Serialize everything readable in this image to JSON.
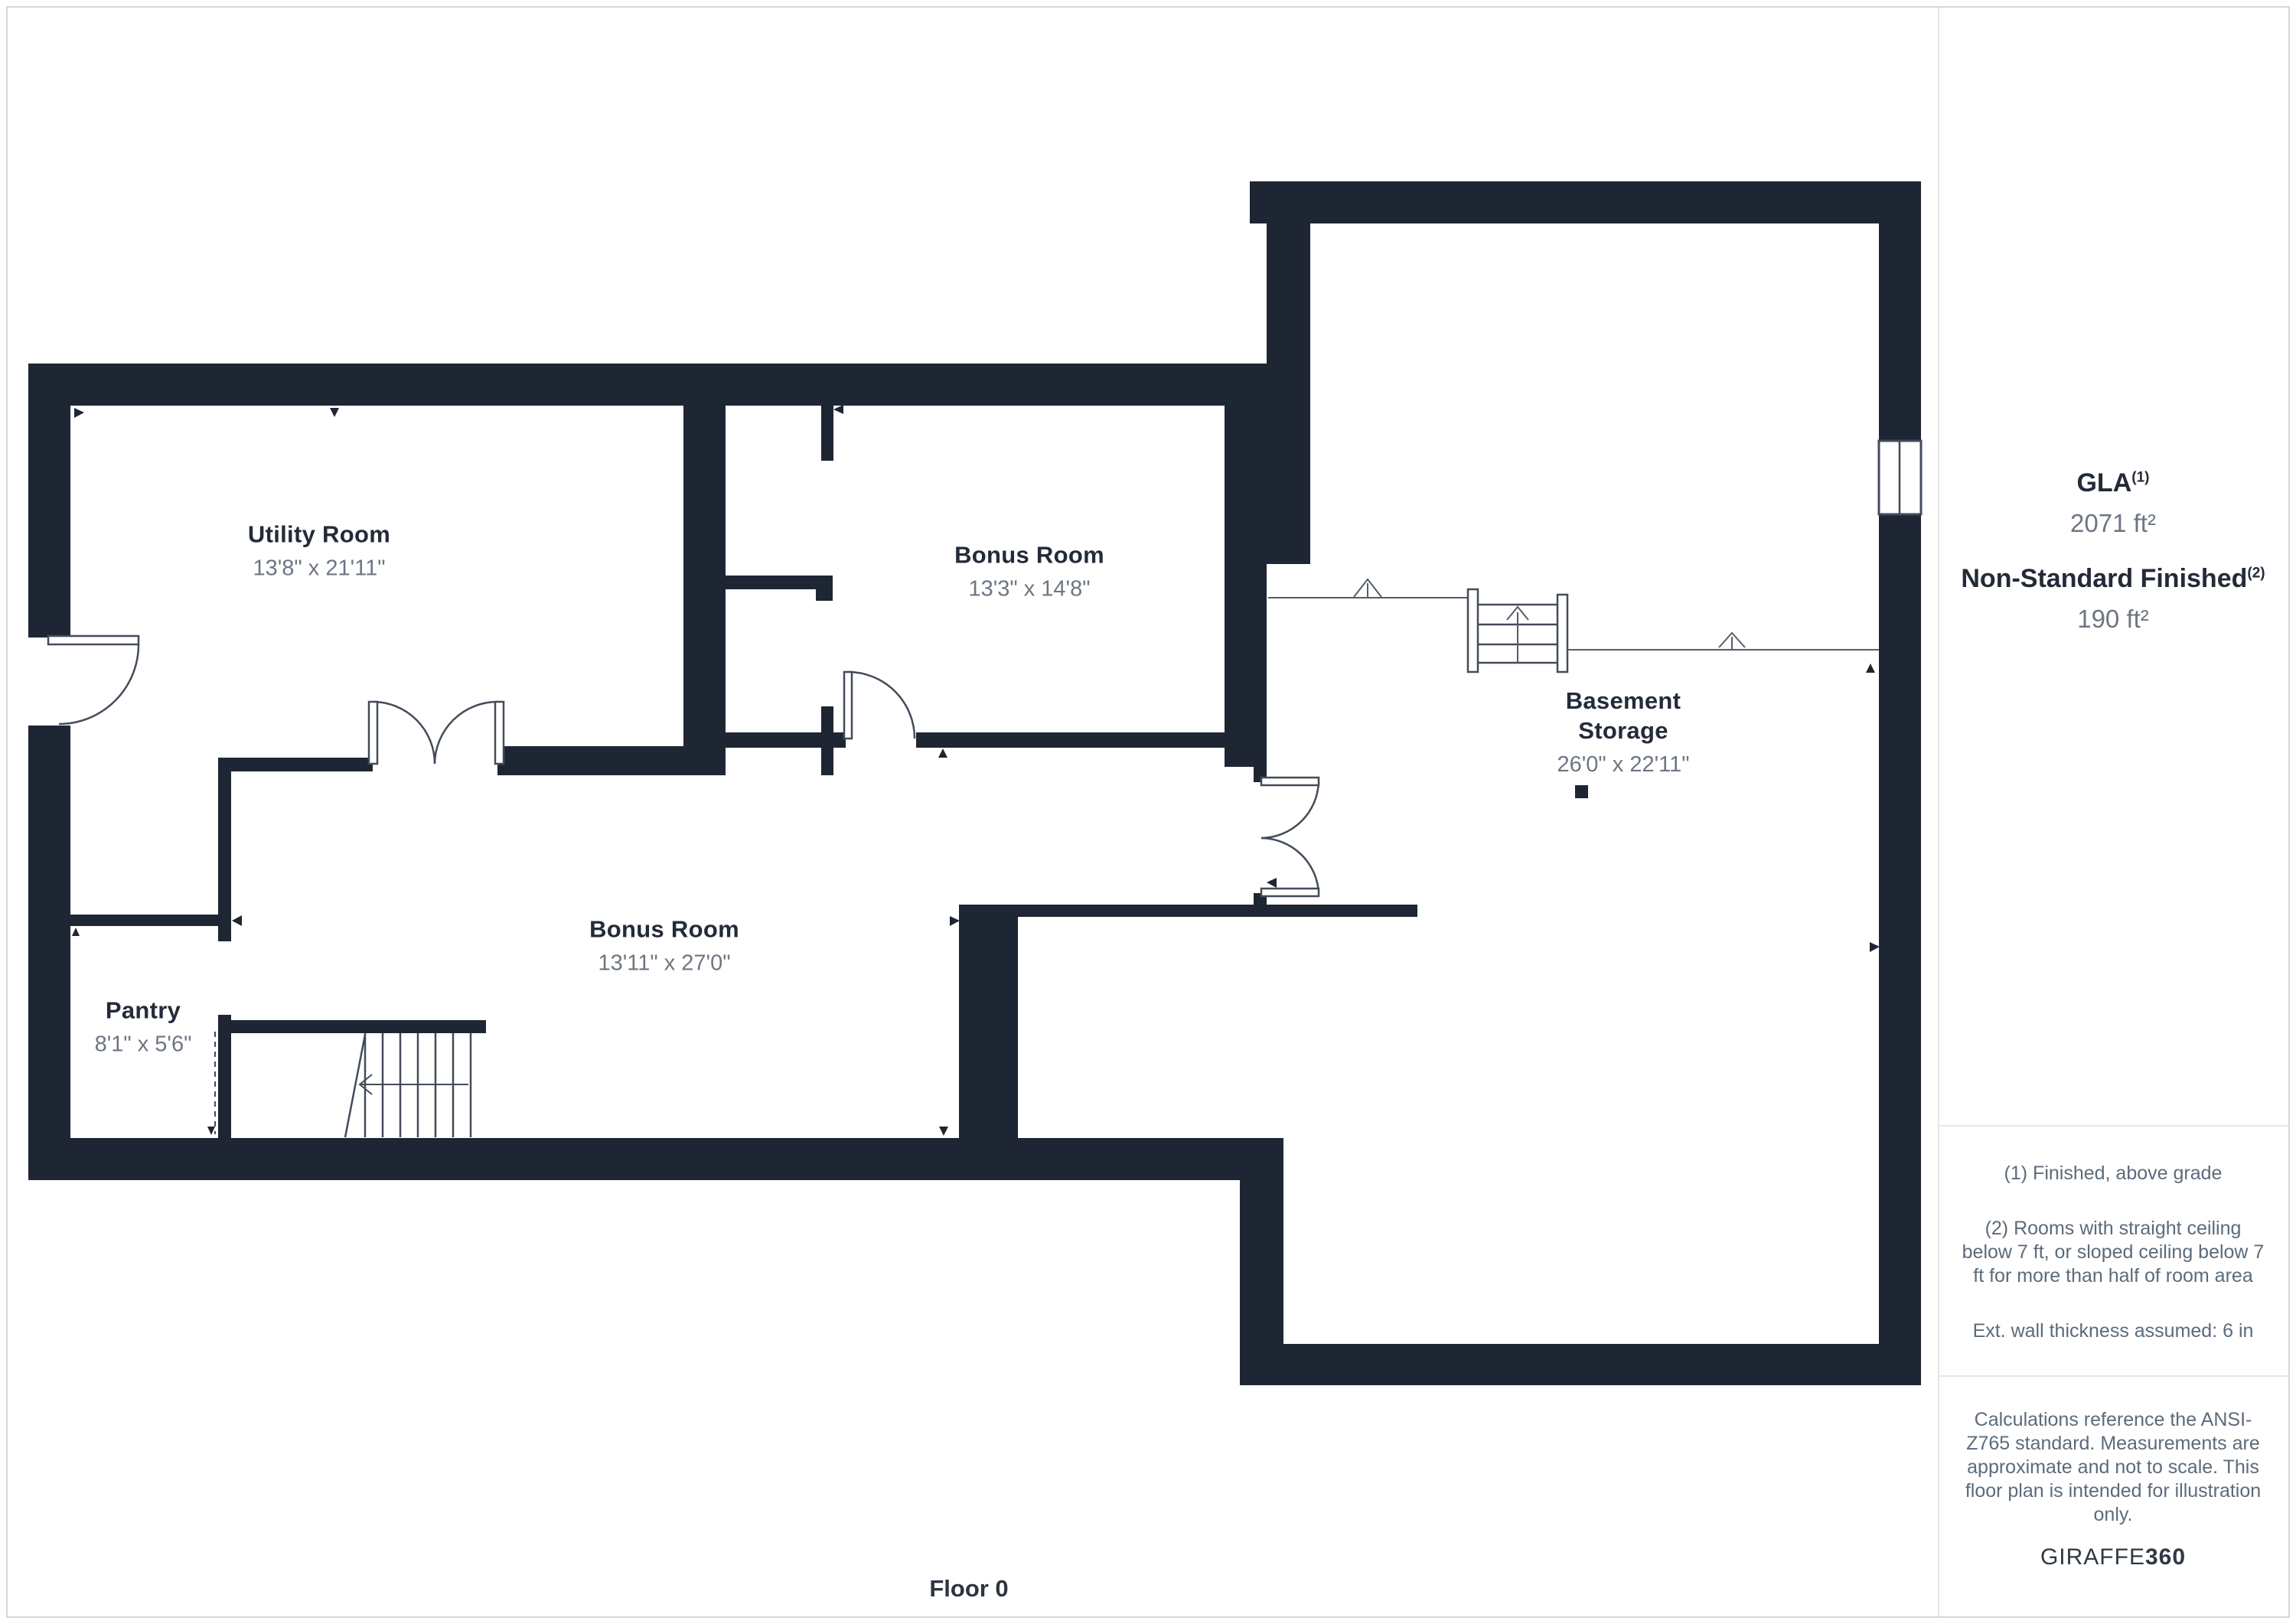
{
  "plan": {
    "floor_label": "Floor 0",
    "rooms": [
      {
        "name": "Utility Room",
        "dims": "13'8\" x 21'11\""
      },
      {
        "name": "Bonus Room",
        "dims": "13'3\" x 14'8\""
      },
      {
        "name": "Basement Storage",
        "dims": "26'0\" x 22'11\""
      },
      {
        "name": "Bonus Room",
        "dims": "13'11\" x 27'0\""
      },
      {
        "name": "Pantry",
        "dims": "8'1\" x 5'6\""
      }
    ]
  },
  "sidebar": {
    "gla": {
      "label": "GLA",
      "superscript": "(1)",
      "value": "2071 ft²"
    },
    "nsf": {
      "label": "Non-Standard Finished",
      "superscript": "(2)",
      "value": "190 ft²"
    },
    "notes": [
      "(1) Finished, above grade",
      "(2) Rooms with straight ceiling below 7 ft, or sloped ceiling below 7 ft for more than half of room area",
      "Ext. wall thickness assumed: 6 in"
    ],
    "disclaimer": "Calculations reference the ANSI-Z765 standard. Measurements are approximate and not to scale. This floor plan is intended for illustration only.",
    "brand": {
      "name": "GIRAFFE",
      "bold": "360"
    }
  },
  "colors": {
    "wall": "#1e2633",
    "line": "#434c59",
    "room_name": "#232b38",
    "dims": "#6d7683",
    "notes": "#5c6b7a"
  }
}
